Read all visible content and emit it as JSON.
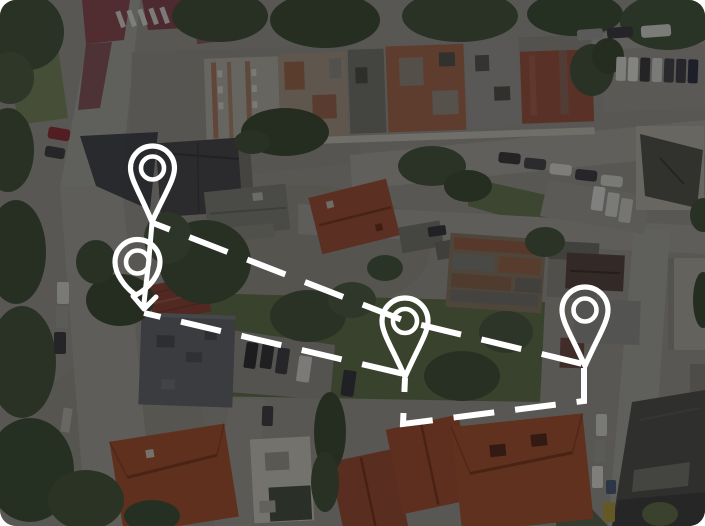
{
  "view": {
    "width": 705,
    "height": 526,
    "corner_radius": 16,
    "background_description": "darkened aerial satellite imagery of a city block with rooftops, streets, trees and parked cars",
    "dim_overlay_color": "#07080a",
    "dim_overlay_opacity": 0.43
  },
  "annotation": {
    "stroke_color": "#ffffff",
    "markers": [
      {
        "name": "map-pin-marker-1",
        "cx": 152.5,
        "cy": 168,
        "r": 22,
        "inner_r": 11.5,
        "tip_x": 152,
        "tip_y": 222
      },
      {
        "name": "map-pin-marker-2",
        "cx": 137.5,
        "cy": 262,
        "r": 22.5,
        "inner_r": 11.5,
        "tip_x": 136,
        "tip_y": 295
      },
      {
        "name": "map-pin-marker-3",
        "cx": 405,
        "cy": 321,
        "r": 23,
        "inner_r": 12,
        "tip_x": 405,
        "tip_y": 377
      },
      {
        "name": "map-pin-marker-4",
        "cx": 585,
        "cy": 310,
        "r": 23,
        "inner_r": 11.5,
        "tip_x": 585,
        "tip_y": 366
      }
    ],
    "marker_stroke_width": 5.2,
    "marker_inner_stroke_width": 4.6,
    "move_arrow": {
      "shaft": [
        [
          152,
          223
        ],
        [
          149,
          258
        ],
        [
          144,
          303
        ]
      ],
      "head": [
        [
          133,
          296
        ],
        [
          144,
          309
        ],
        [
          156,
          297
        ]
      ],
      "stroke_width": 5
    },
    "dashed_paths": [
      {
        "name": "dashed-route-top",
        "points": [
          [
            153,
            223
          ],
          [
            405,
            321
          ],
          [
            583,
            364
          ]
        ],
        "dash": [
          41,
          21
        ],
        "offset": 23,
        "stroke_width": 6
      },
      {
        "name": "dashed-route-middle",
        "points": [
          [
            144,
            313
          ],
          [
            404,
            374
          ]
        ],
        "dash": [
          41,
          21
        ],
        "offset": 24,
        "stroke_width": 6
      },
      {
        "name": "dashed-route-bottom",
        "points": [
          [
            405,
            378
          ],
          [
            403,
            424
          ],
          [
            584,
            401
          ],
          [
            584,
            368
          ]
        ],
        "dash": [
          41,
          21
        ],
        "offset": 27,
        "stroke_width": 6
      }
    ]
  }
}
